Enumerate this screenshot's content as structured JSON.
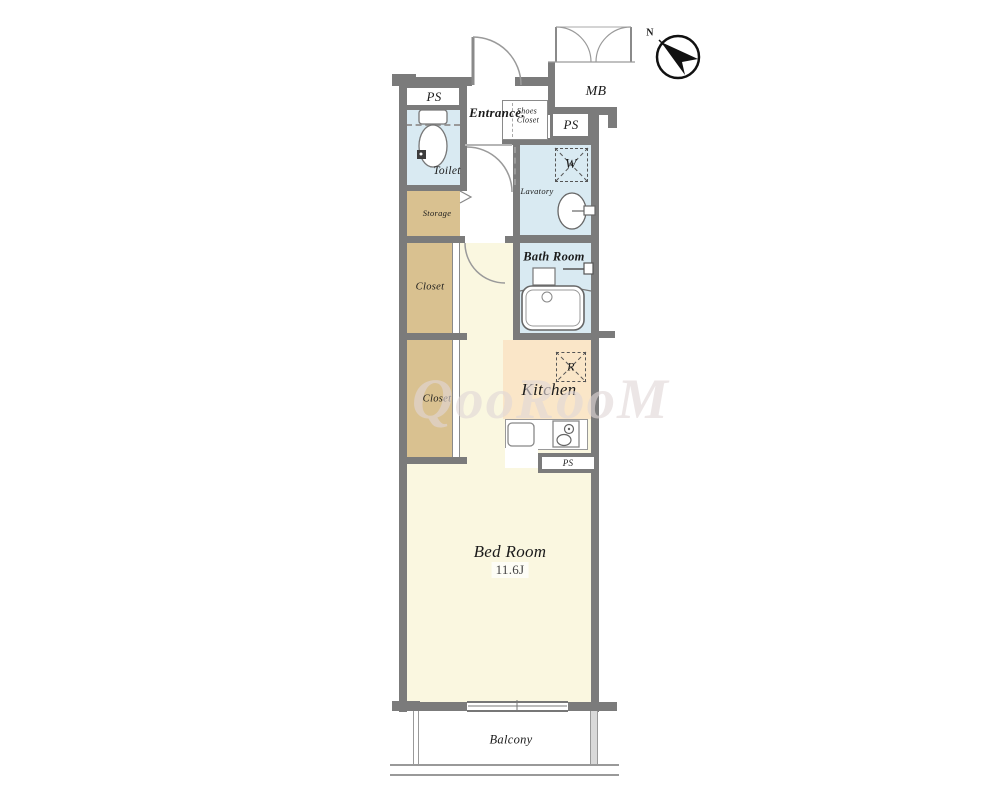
{
  "plan_type": "apartment-floorplan",
  "watermark": {
    "text": "QooRooM"
  },
  "compass": {
    "north_label": "N"
  },
  "labels": {
    "entrance": "Entrance.",
    "shoes_closet_line1": "Shoes",
    "shoes_closet_line2": "Closet",
    "mb": "MB",
    "ps_top_left": "PS",
    "ps_mid_right": "PS",
    "ps_kitchen": "PS",
    "toilet": "Toilet",
    "storage": "Storage",
    "closet_upper": "Closet",
    "closet_lower": "Closet",
    "lavatory": "Lavatory",
    "washer": "W",
    "bath_room": "Bath Room",
    "kitchen": "Kitchen",
    "refrigerator": "R",
    "bed_room": "Bed Room",
    "bed_room_size": "11.6J",
    "balcony": "Balcony"
  },
  "colors": {
    "wall": "#7b7b7b",
    "floor_cream": "#faf7e0",
    "floor_peach": "#fae6c8",
    "floor_blue": "#d9eaf2",
    "floor_tan": "#d9c190",
    "line": "#999999",
    "watermark": "#e1d6d6"
  }
}
